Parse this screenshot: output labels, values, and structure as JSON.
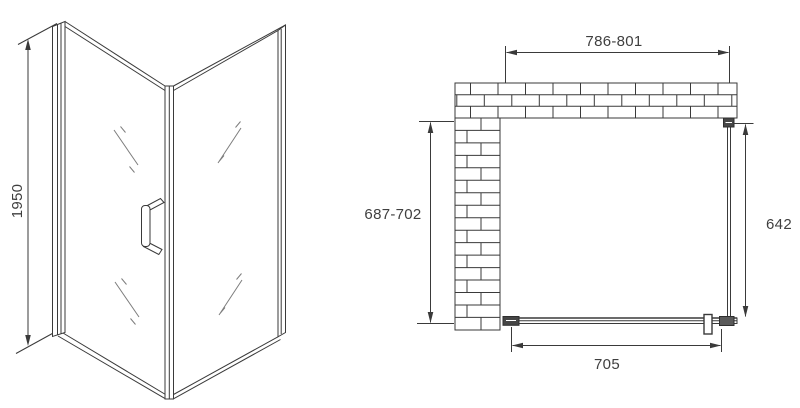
{
  "drawing": {
    "front_view": {
      "height_dimension": "1950"
    },
    "plan_view": {
      "opening_width_dimension": "786-801",
      "wall_depth_dimension": "687-702",
      "side_panel_dimension": "642",
      "door_width_dimension": "705"
    },
    "colors": {
      "line": "#3a3a3a",
      "glass_mark": "#7d7d7d",
      "background": "#ffffff"
    }
  }
}
